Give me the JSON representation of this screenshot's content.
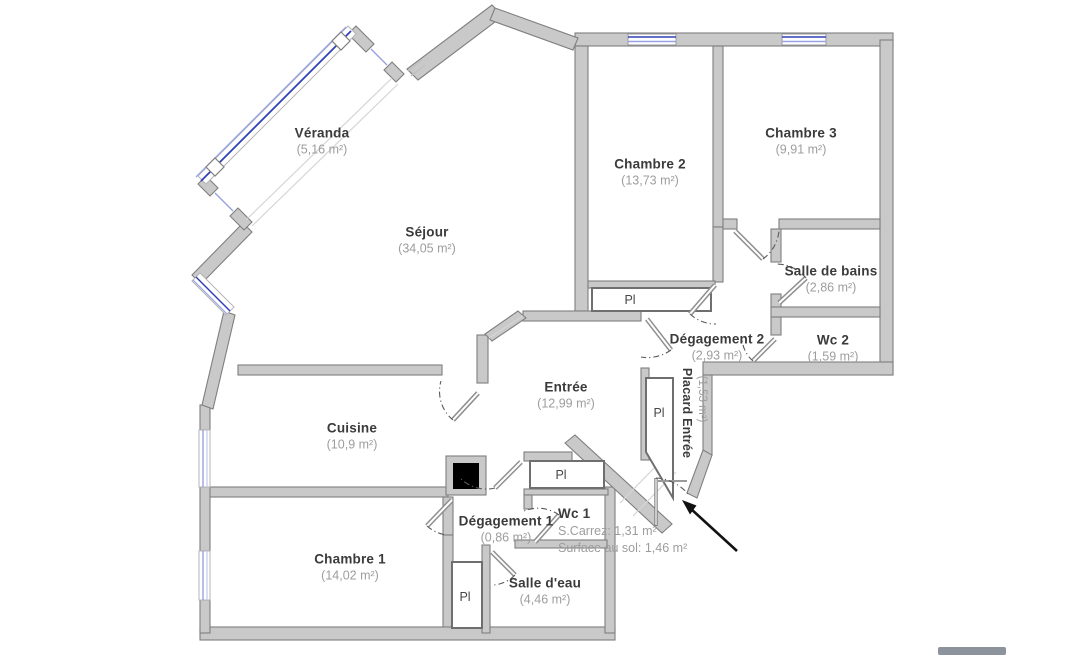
{
  "plan_type": "apartment-floor-plan",
  "rooms": [
    {
      "id": "veranda",
      "name": "Véranda",
      "area": "(5,16 m²)"
    },
    {
      "id": "sejour",
      "name": "Séjour",
      "area": "(34,05 m²)"
    },
    {
      "id": "chambre2",
      "name": "Chambre 2",
      "area": "(13,73 m²)"
    },
    {
      "id": "chambre3",
      "name": "Chambre 3",
      "area": "(9,91 m²)"
    },
    {
      "id": "salle-de-bains",
      "name": "Salle de bains",
      "area": "(2,86 m²)"
    },
    {
      "id": "wc2",
      "name": "Wc 2",
      "area": "(1,59 m²)"
    },
    {
      "id": "degagement2",
      "name": "Dégagement 2",
      "area": "(2,93 m²)"
    },
    {
      "id": "placard-entree",
      "name": "Placard Entrée",
      "area": "(1,53 m²)"
    },
    {
      "id": "entree",
      "name": "Entrée",
      "area": "(12,99 m²)"
    },
    {
      "id": "cuisine",
      "name": "Cuisine",
      "area": "(10,9 m²)"
    },
    {
      "id": "degagement1",
      "name": "Dégagement 1",
      "area": "(0,86 m²)"
    },
    {
      "id": "wc1",
      "name": "Wc 1",
      "area_carrez": "S.Carrez: 1,31 m²",
      "area_floor": "Surface au sol: 1,46 m²"
    },
    {
      "id": "salle-deau",
      "name": "Salle d'eau",
      "area": "(4,46 m²)"
    },
    {
      "id": "chambre1",
      "name": "Chambre 1",
      "area": "(14,02 m²)"
    }
  ],
  "labels": {
    "closet": "Pl"
  },
  "colors": {
    "background": "#ffffff",
    "wall_fill": "#c9c9c9",
    "wall_outline": "#7f7f7f",
    "window_glass": "#3140b6",
    "window_glass_light": "#98a1e2",
    "room_name": "#3b3b3b",
    "room_area": "#9d9d9d",
    "door_arc": "#5a5a5a",
    "arrow": "#121212",
    "conduit": "#000000"
  }
}
